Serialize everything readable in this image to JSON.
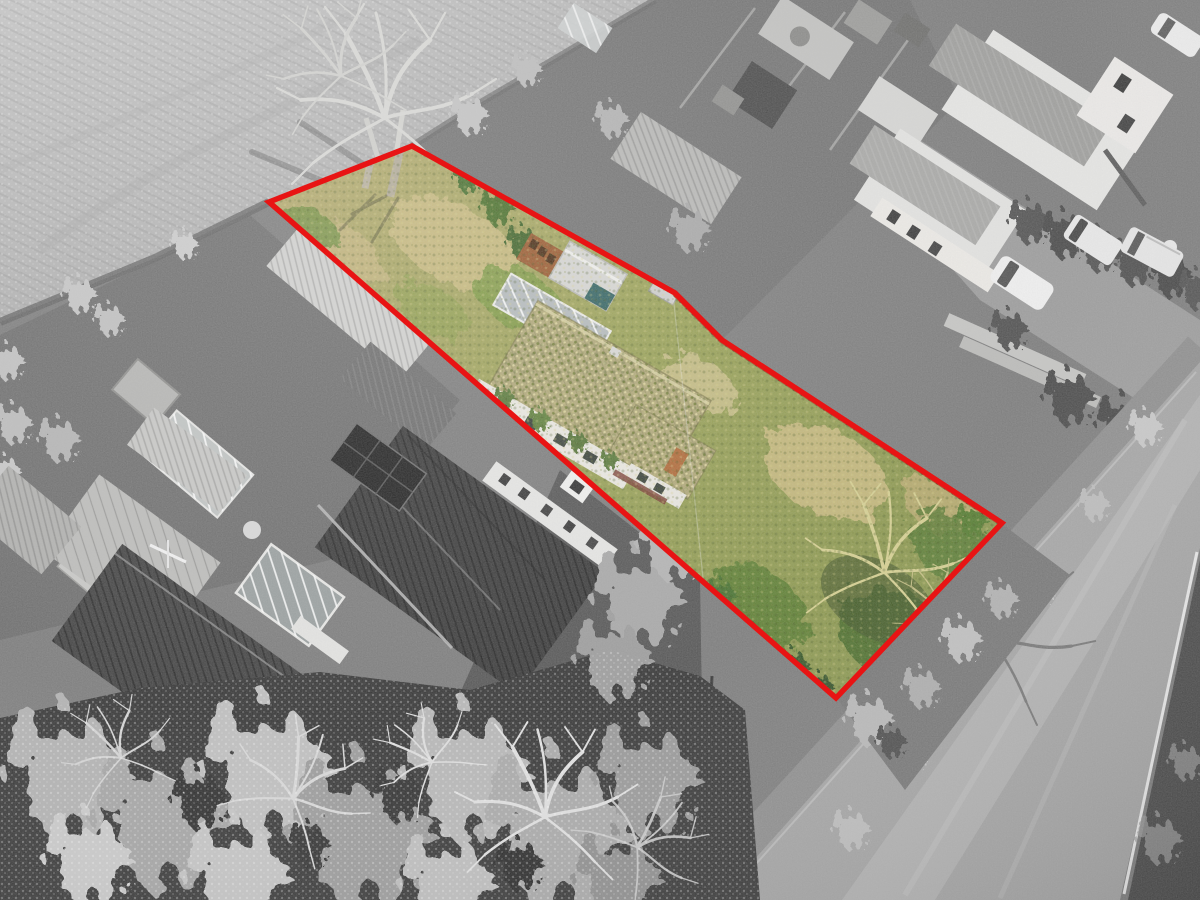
{
  "image": {
    "type": "aerial-property-photograph",
    "width": 1200,
    "height": 900,
    "effect": "selective-colour",
    "description": "Drone view of an overgrown development plot outlined in red; the plot interior is shown in colour while the ploughed field, neighbouring gardens, houses, trees and road around it are desaturated to greyscale."
  },
  "boundary": {
    "label": "plot-boundary",
    "color": "#e81414",
    "stroke_width": 5.5,
    "points_str": "269,202 412,146 675,293 722,340 860,430 1002,523 836,698",
    "vertices": [
      [
        269,
        202
      ],
      [
        412,
        146
      ],
      [
        675,
        293
      ],
      [
        722,
        340
      ],
      [
        860,
        430
      ],
      [
        1002,
        523
      ],
      [
        836,
        698
      ]
    ]
  },
  "plot": {
    "contents": [
      "overgrown straw grass",
      "green scrub and brambles",
      "moss-covered bungalow roof",
      "glazed panel row",
      "grey shed with teal doors",
      "rusty slatted store",
      "orange timber fence",
      "bare tree with yellow branches",
      "green bushes",
      "white rendered walls with windows"
    ],
    "colors": {
      "grass_straw": "#c9ba80",
      "grass_green": "#8f9a55",
      "bush_green": "#46702e",
      "moss_roof": "#b0a878",
      "fence_brown": "#9a5a2e",
      "shed_teal": "#346463",
      "wall_white": "#eae8e1",
      "brick_orange": "#b06a38"
    }
  },
  "surroundings": {
    "style": "greyscale",
    "elements": [
      "ploughed frosty field",
      "large bare tree",
      "neighbouring gardens",
      "greenhouse",
      "garden sheds",
      "pergola outbuilding",
      "bungalow with dark tiled hip roof",
      "conservatory",
      "house with steep tiled roofs",
      "solar panel array",
      "two-storey white houses",
      "driveway",
      "hedges",
      "timber stack",
      "road with white edge line",
      "grass verge",
      "frost-covered tree canopy"
    ],
    "colors": {
      "field_grey": "#bcbcbc",
      "garden_grey": "#7a7a7a",
      "roof_dark": "#3d3d3d",
      "roof_pale": "#c7c7c5",
      "wall_grey_white": "#e8e8e6",
      "road_grey": "#a6a6a6",
      "road_line": "#eaeaea",
      "frost": "#c9c9c9",
      "canopy_dark": "#383838"
    }
  },
  "vehicles": [
    {
      "name": "white-hatchback-on-driveway"
    },
    {
      "name": "white-van"
    },
    {
      "name": "white-motorhome"
    },
    {
      "name": "white-car-top-corner"
    }
  ]
}
